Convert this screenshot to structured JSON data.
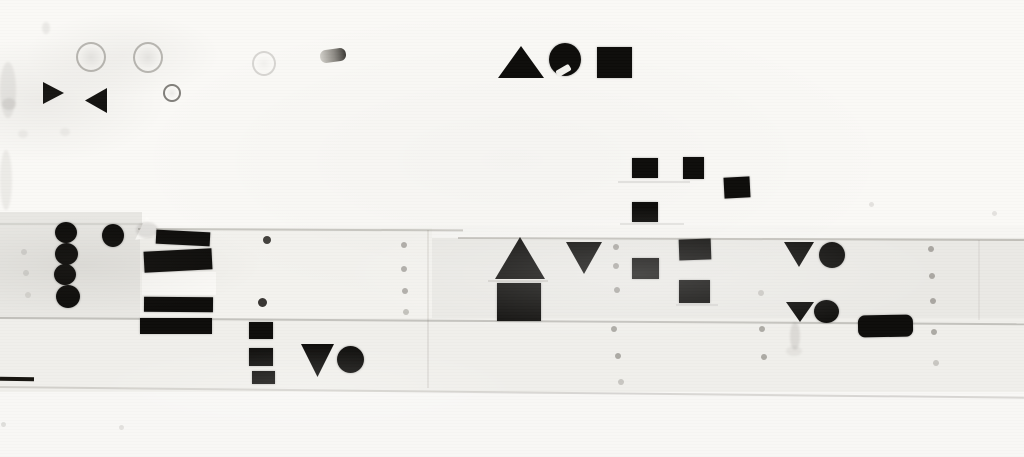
{
  "canvas": {
    "width": 1024,
    "height": 457,
    "base_color": "#f7f6f3"
  },
  "palette": {
    "shape_black": "#0d0c0a",
    "wall_white": "#faf9f6",
    "wall_gray": "#eae9e5"
  },
  "panels": [
    {
      "type": "panel",
      "name": "wall-top-board",
      "x": 0,
      "y": 0,
      "w": 1024,
      "h": 226,
      "color": "#faf9f6"
    },
    {
      "type": "panel",
      "name": "wall-mid-band-left",
      "x": 0,
      "y": 212,
      "w": 142,
      "h": 108,
      "color": "#e8e7e3"
    },
    {
      "type": "panel",
      "name": "wall-mid-band-right",
      "x": 430,
      "y": 238,
      "w": 594,
      "h": 84,
      "color": "#eae9e5"
    },
    {
      "type": "panel",
      "name": "wall-white-panel",
      "x": 140,
      "y": 228,
      "w": 292,
      "h": 92,
      "color": "#f3f2ee"
    },
    {
      "type": "panel",
      "name": "wall-bright-strip",
      "x": 142,
      "y": 272,
      "w": 74,
      "h": 23,
      "color": "#fbfaf7"
    },
    {
      "type": "panel",
      "name": "wall-lower-band",
      "x": 0,
      "y": 318,
      "w": 1024,
      "h": 74,
      "color": "#f0efeb"
    },
    {
      "type": "panel",
      "name": "wall-bottom-board",
      "x": 0,
      "y": 392,
      "w": 1024,
      "h": 65,
      "color": "#f8f7f5"
    }
  ],
  "seams": [
    {
      "type": "seam-h",
      "name": "board-seam-top-left",
      "x": 0,
      "y": 223,
      "w": 150,
      "alpha": 0.4
    },
    {
      "type": "seam-h",
      "name": "board-seam-top-mid",
      "x": 138,
      "y": 228,
      "w": 325,
      "alpha": 0.85,
      "rot": 0.25
    },
    {
      "type": "seam-h",
      "name": "board-seam-top-right",
      "x": 458,
      "y": 237,
      "w": 566,
      "alpha": 0.85,
      "rot": 0.2
    },
    {
      "type": "seam-h",
      "name": "board-seam-middle",
      "x": 0,
      "y": 317,
      "w": 1024,
      "alpha": 0.9,
      "rot": 0.35
    },
    {
      "type": "seam-h",
      "name": "board-seam-bottom",
      "x": 0,
      "y": 386,
      "w": 1024,
      "alpha": 0.6,
      "rot": 0.6
    },
    {
      "type": "seam-h",
      "name": "triangle-base-shadow",
      "x": 488,
      "y": 280,
      "w": 60,
      "alpha": 0.5
    },
    {
      "type": "seam-h",
      "name": "square-underline-1",
      "x": 618,
      "y": 181,
      "w": 72,
      "alpha": 0.4
    },
    {
      "type": "seam-h",
      "name": "square-underline-2",
      "x": 620,
      "y": 223,
      "w": 64,
      "alpha": 0.4
    },
    {
      "type": "seam-h",
      "name": "square-underline-3",
      "x": 676,
      "y": 304,
      "w": 42,
      "alpha": 0.35
    },
    {
      "type": "seam-v",
      "name": "board-seam-vertical-1",
      "x": 427,
      "y": 230,
      "h": 158,
      "alpha": 0.55
    },
    {
      "type": "seam-v",
      "name": "board-seam-vertical-2",
      "x": 978,
      "y": 240,
      "h": 80,
      "alpha": 0.35
    }
  ],
  "marks": [
    {
      "type": "ring",
      "name": "grommet-ring",
      "x": 76,
      "y": 42,
      "w": 26,
      "h": 26
    },
    {
      "type": "ring",
      "name": "grommet-ring",
      "x": 133,
      "y": 42,
      "w": 26,
      "h": 27
    },
    {
      "type": "ring",
      "name": "grommet-ring",
      "x": 252,
      "y": 51,
      "w": 20,
      "h": 21,
      "alpha": 0.55
    },
    {
      "type": "ring",
      "name": "small-eyelet-ring",
      "x": 163,
      "y": 84,
      "w": 14,
      "h": 14,
      "border": "rgba(48,45,40,.6)"
    },
    {
      "type": "pin",
      "name": "metal-pin",
      "x": 320,
      "y": 49,
      "w": 26,
      "h": 13,
      "rot": -8
    },
    {
      "type": "fold",
      "name": "paper-fold-highlight",
      "x": 135,
      "y": 216,
      "w": 26,
      "h": 24
    },
    {
      "type": "smudge",
      "name": "corner-smudge",
      "x": 136,
      "y": 222,
      "w": 22,
      "h": 16,
      "alpha": 0.8
    },
    {
      "type": "smudge",
      "name": "edge-smudge",
      "x": 0,
      "y": 62,
      "w": 16,
      "h": 56,
      "alpha": 0.5
    },
    {
      "type": "smudge",
      "name": "edge-smudge",
      "x": 0,
      "y": 150,
      "w": 12,
      "h": 60,
      "alpha": 0.45
    },
    {
      "type": "smudge",
      "name": "edge-smudge",
      "x": 2,
      "y": 98,
      "w": 14,
      "h": 12,
      "alpha": 0.6
    },
    {
      "type": "smudge",
      "name": "small-smudge",
      "x": 42,
      "y": 22,
      "w": 8,
      "h": 12,
      "alpha": 0.5
    },
    {
      "type": "smudge",
      "name": "small-smudge",
      "x": 60,
      "y": 128,
      "w": 10,
      "h": 8,
      "alpha": 0.35
    },
    {
      "type": "smudge",
      "name": "small-smudge",
      "x": 18,
      "y": 130,
      "w": 10,
      "h": 8,
      "alpha": 0.35
    },
    {
      "type": "smudge",
      "name": "drip-streak",
      "x": 790,
      "y": 322,
      "w": 10,
      "h": 28,
      "alpha": 0.7
    },
    {
      "type": "smudge",
      "name": "drip-streak",
      "x": 786,
      "y": 346,
      "w": 16,
      "h": 10,
      "alpha": 0.4
    },
    {
      "type": "dot",
      "name": "small-black-dot",
      "x": 263,
      "y": 236,
      "w": 8,
      "h": 8,
      "color": "rgba(22,20,16,.8)"
    },
    {
      "type": "dot",
      "name": "small-black-dot",
      "x": 258,
      "y": 298,
      "w": 9,
      "h": 9,
      "color": "rgba(22,20,16,.85)"
    },
    {
      "type": "dot",
      "name": "rivet-dot",
      "x": 401,
      "y": 242,
      "w": 6,
      "h": 6
    },
    {
      "type": "dot",
      "name": "rivet-dot",
      "x": 401,
      "y": 266,
      "w": 6,
      "h": 6
    },
    {
      "type": "dot",
      "name": "rivet-dot",
      "x": 402,
      "y": 288,
      "w": 6,
      "h": 6
    },
    {
      "type": "dot",
      "name": "rivet-dot",
      "x": 403,
      "y": 309,
      "w": 6,
      "h": 6,
      "alpha": 0.7
    },
    {
      "type": "dot",
      "name": "rivet-dot",
      "x": 613,
      "y": 244,
      "w": 6,
      "h": 6
    },
    {
      "type": "dot",
      "name": "rivet-dot",
      "x": 613,
      "y": 263,
      "w": 6,
      "h": 6
    },
    {
      "type": "dot",
      "name": "rivet-dot",
      "x": 614,
      "y": 287,
      "w": 6,
      "h": 6
    },
    {
      "type": "dot",
      "name": "rivet-dot",
      "x": 611,
      "y": 326,
      "w": 6,
      "h": 6
    },
    {
      "type": "dot",
      "name": "rivet-dot",
      "x": 615,
      "y": 353,
      "w": 6,
      "h": 6
    },
    {
      "type": "dot",
      "name": "rivet-dot",
      "x": 618,
      "y": 379,
      "w": 6,
      "h": 6,
      "alpha": 0.6
    },
    {
      "type": "dot",
      "name": "rivet-dot",
      "x": 758,
      "y": 290,
      "w": 6,
      "h": 6,
      "alpha": 0.5
    },
    {
      "type": "dot",
      "name": "rivet-dot",
      "x": 759,
      "y": 326,
      "w": 6,
      "h": 6
    },
    {
      "type": "dot",
      "name": "rivet-dot",
      "x": 761,
      "y": 354,
      "w": 6,
      "h": 6
    },
    {
      "type": "dot",
      "name": "rivet-dot",
      "x": 928,
      "y": 246,
      "w": 6,
      "h": 6
    },
    {
      "type": "dot",
      "name": "rivet-dot",
      "x": 929,
      "y": 273,
      "w": 6,
      "h": 6
    },
    {
      "type": "dot",
      "name": "rivet-dot",
      "x": 930,
      "y": 298,
      "w": 6,
      "h": 6
    },
    {
      "type": "dot",
      "name": "rivet-dot",
      "x": 931,
      "y": 329,
      "w": 6,
      "h": 6
    },
    {
      "type": "dot",
      "name": "rivet-dot",
      "x": 933,
      "y": 360,
      "w": 6,
      "h": 6,
      "alpha": 0.6
    },
    {
      "type": "dot",
      "name": "faint-dot",
      "x": 869,
      "y": 202,
      "w": 5,
      "h": 5,
      "alpha": 0.3
    },
    {
      "type": "dot",
      "name": "faint-dot",
      "x": 992,
      "y": 211,
      "w": 5,
      "h": 5,
      "alpha": 0.3
    },
    {
      "type": "dot",
      "name": "faint-dot",
      "x": 21,
      "y": 249,
      "w": 6,
      "h": 6,
      "alpha": 0.35
    },
    {
      "type": "dot",
      "name": "faint-dot",
      "x": 23,
      "y": 270,
      "w": 6,
      "h": 6,
      "alpha": 0.35
    },
    {
      "type": "dot",
      "name": "faint-dot",
      "x": 25,
      "y": 292,
      "w": 6,
      "h": 6,
      "alpha": 0.3
    },
    {
      "type": "dot",
      "name": "faint-dot",
      "x": 1,
      "y": 422,
      "w": 5,
      "h": 5,
      "alpha": 0.35
    },
    {
      "type": "dot",
      "name": "faint-dot",
      "x": 119,
      "y": 425,
      "w": 5,
      "h": 5,
      "alpha": 0.3
    },
    {
      "type": "dash",
      "name": "edge-dark-dash",
      "x": 0,
      "y": 377,
      "w": 34,
      "h": 4,
      "rot": 1
    }
  ],
  "shapes": [
    {
      "type": "tri-right",
      "name": "black-triangle-right",
      "x": 43,
      "y": 82,
      "w": 21,
      "h": 22
    },
    {
      "type": "tri-left",
      "name": "black-triangle-left",
      "x": 85,
      "y": 88,
      "w": 22,
      "h": 25
    },
    {
      "type": "tri-up",
      "name": "black-triangle-up",
      "x": 498,
      "y": 46,
      "w": 46,
      "h": 32
    },
    {
      "type": "circle",
      "name": "black-circle",
      "x": 549,
      "y": 43,
      "w": 32,
      "h": 33
    },
    {
      "type": "notch",
      "name": "circle-white-notch",
      "x": 556,
      "y": 67,
      "w": 15,
      "h": 7,
      "rot": -30
    },
    {
      "type": "square",
      "name": "black-square",
      "x": 597,
      "y": 47,
      "w": 35,
      "h": 31
    },
    {
      "type": "square",
      "name": "black-square",
      "x": 632,
      "y": 158,
      "w": 26,
      "h": 20
    },
    {
      "type": "square",
      "name": "black-square",
      "x": 683,
      "y": 157,
      "w": 21,
      "h": 22
    },
    {
      "type": "square",
      "name": "black-square",
      "x": 724,
      "y": 177,
      "w": 26,
      "h": 21,
      "rot": -3
    },
    {
      "type": "square",
      "name": "black-square",
      "x": 632,
      "y": 202,
      "w": 26,
      "h": 20
    },
    {
      "type": "circle",
      "name": "black-circle",
      "x": 55,
      "y": 222,
      "w": 22,
      "h": 21
    },
    {
      "type": "circle",
      "name": "black-circle",
      "x": 55,
      "y": 243,
      "w": 23,
      "h": 22
    },
    {
      "type": "circle",
      "name": "black-circle",
      "x": 54,
      "y": 264,
      "w": 22,
      "h": 21
    },
    {
      "type": "circle",
      "name": "black-circle",
      "x": 56,
      "y": 285,
      "w": 24,
      "h": 23
    },
    {
      "type": "circle",
      "name": "black-circle",
      "x": 102,
      "y": 224,
      "w": 22,
      "h": 23
    },
    {
      "type": "bar",
      "name": "black-stripe",
      "x": 156,
      "y": 231,
      "w": 54,
      "h": 14,
      "rot": 3
    },
    {
      "type": "bar",
      "name": "black-stripe",
      "x": 144,
      "y": 250,
      "w": 68,
      "h": 21,
      "rot": -3
    },
    {
      "type": "bar",
      "name": "black-stripe",
      "x": 144,
      "y": 297,
      "w": 69,
      "h": 15,
      "rot": 0.5
    },
    {
      "type": "bar",
      "name": "black-stripe",
      "x": 140,
      "y": 318,
      "w": 72,
      "h": 16
    },
    {
      "type": "square",
      "name": "black-square",
      "x": 249,
      "y": 322,
      "w": 24,
      "h": 17
    },
    {
      "type": "square",
      "name": "black-square",
      "x": 249,
      "y": 348,
      "w": 24,
      "h": 18
    },
    {
      "type": "square",
      "name": "black-square",
      "x": 252,
      "y": 371,
      "w": 23,
      "h": 13
    },
    {
      "type": "tri-down",
      "name": "black-triangle-down",
      "x": 301,
      "y": 344,
      "w": 33,
      "h": 33
    },
    {
      "type": "circle",
      "name": "black-circle",
      "x": 337,
      "y": 346,
      "w": 27,
      "h": 27
    },
    {
      "type": "tri-up",
      "name": "black-triangle-up",
      "x": 495,
      "y": 237,
      "w": 50,
      "h": 42
    },
    {
      "type": "square",
      "name": "black-square",
      "x": 497,
      "y": 283,
      "w": 44,
      "h": 38
    },
    {
      "type": "tri-down",
      "name": "black-triangle-down",
      "x": 566,
      "y": 242,
      "w": 36,
      "h": 32
    },
    {
      "type": "square",
      "name": "black-square",
      "x": 632,
      "y": 258,
      "w": 27,
      "h": 21
    },
    {
      "type": "square",
      "name": "black-square",
      "x": 679,
      "y": 239,
      "w": 32,
      "h": 21,
      "rot": -2
    },
    {
      "type": "square",
      "name": "black-square",
      "x": 679,
      "y": 280,
      "w": 31,
      "h": 23
    },
    {
      "type": "tri-down",
      "name": "black-triangle-down",
      "x": 784,
      "y": 242,
      "w": 30,
      "h": 25
    },
    {
      "type": "circle",
      "name": "black-circle",
      "x": 819,
      "y": 242,
      "w": 26,
      "h": 26
    },
    {
      "type": "tri-down",
      "name": "black-triangle-down",
      "x": 786,
      "y": 302,
      "w": 28,
      "h": 20
    },
    {
      "type": "circle",
      "name": "black-circle",
      "x": 814,
      "y": 300,
      "w": 25,
      "h": 23
    },
    {
      "type": "rect",
      "name": "black-rounded-bar",
      "x": 858,
      "y": 315,
      "w": 55,
      "h": 22,
      "radius": 7,
      "rot": -1
    }
  ]
}
